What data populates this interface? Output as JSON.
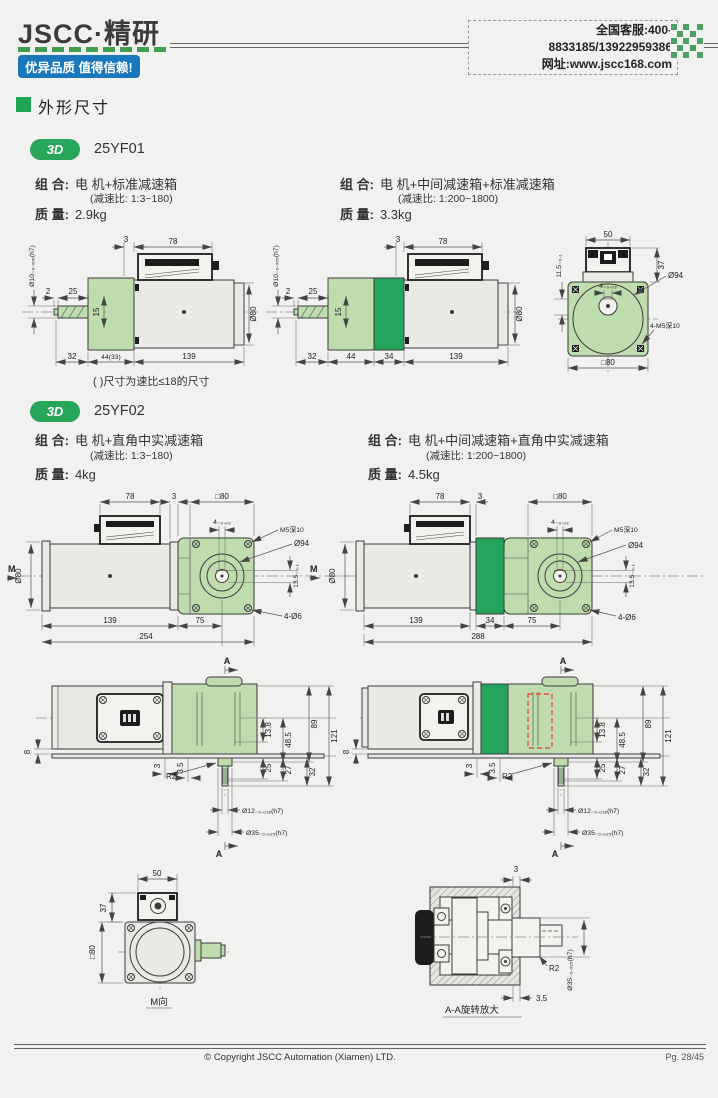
{
  "header": {
    "logo": "JSCC·精研",
    "slogan": "优异品质 值得信赖!",
    "service_line": "全国客服:400-8833185/13922959386",
    "website_line": "网址:www.jscc168.com"
  },
  "section": {
    "title": "外形尺寸"
  },
  "labels": {
    "combo": "组 合:",
    "mass": "质 量:"
  },
  "models": [
    {
      "badge": "3D",
      "name": "25YF01",
      "left": {
        "combo": "电 机+标准减速箱",
        "ratio": "(减速比: 1:3~180)",
        "mass": "2.9kg"
      },
      "right": {
        "combo": "电 机+中间减速箱+标准减速箱",
        "ratio": "(减速比: 1:200~1800)",
        "mass": "3.3kg"
      },
      "note": "( )尺寸为速比≤18的尺寸"
    },
    {
      "badge": "3D",
      "name": "25YF02",
      "left": {
        "combo": "电 机+直角中实减速箱",
        "ratio": "(减速比: 1:3~180)",
        "mass": "4kg"
      },
      "right": {
        "combo": "电 机+中间减速箱+直角中实减速箱",
        "ratio": "(减速比: 1:200~1800)",
        "mass": "4.5kg"
      }
    }
  ],
  "dims": {
    "yf01_left": {
      "t3": "3",
      "t78": "78",
      "shaft_dia": "Ø10₋₀.₀₀₅(h7)",
      "d2": "2",
      "d25": "25",
      "d15": "15",
      "dia80": "Ø80",
      "b32": "32",
      "b44": "44(33)",
      "b139": "139"
    },
    "yf01_mid": {
      "t3": "3",
      "t78": "78",
      "shaft_dia": "Ø10₋₀.₀₀₅(h7)",
      "d2": "2",
      "d25": "25",
      "d15": "15",
      "dia80": "Ø80",
      "b32": "32",
      "b44": "44",
      "b34": "34",
      "b139": "139"
    },
    "yf01_front": {
      "t50": "50",
      "r37": "37",
      "key": "4₋₀.₀₃",
      "dia94": "Ø94",
      "tap": "4-M5深10",
      "sq80": "□80",
      "kh": "11.5₋₀.₁"
    },
    "yf02_left": {
      "m": "M",
      "t78": "78",
      "t3": "3",
      "sq80": "□80",
      "key": "4₋₀.₀₃",
      "tap": "M5深10",
      "dia94": "Ø94",
      "dia80": "Ø80",
      "kh": "13.5₋₀.₁",
      "holes": "4-Ø6",
      "b139": "139",
      "b75": "75",
      "b254": "254"
    },
    "yf02_right": {
      "m": "M",
      "t78": "78",
      "t3": "3",
      "sq80": "□80",
      "key": "4₋₀.₀₃",
      "tap": "M5深10",
      "dia94": "Ø94",
      "dia80": "Ø80",
      "kh": "13.5₋₀.₁",
      "holes": "4-Ø6",
      "b139": "139",
      "b34": "34",
      "b75": "75",
      "b288": "288"
    },
    "side_left": {
      "a": "A",
      "d8": "8",
      "d3": "3",
      "d35": "3.5",
      "r2": "R2",
      "v138": "13.8",
      "v485": "48.5",
      "v89": "89",
      "v121": "121",
      "v25": "25",
      "v27": "27",
      "v32": "32",
      "shaft": "Ø12₋₀.₀₁₈(h7)",
      "boss": "Ø35₋₀.₀₂₅(h7)"
    },
    "side_right": {
      "a": "A",
      "d8": "8",
      "d3": "3",
      "d35": "3.5",
      "r2": "R2",
      "v138": "13.8",
      "v485": "48.5",
      "v89": "89",
      "v121": "121",
      "v25": "25",
      "v27": "27",
      "v32": "32",
      "shaft": "Ø12₋₀.₀₁₈(h7)",
      "boss": "Ø35₋₀.₀₂₅(h7)"
    },
    "m_view": {
      "t50": "50",
      "r37": "37",
      "sq80": "□80",
      "caption": "M向"
    },
    "aa_view": {
      "t3": "3",
      "r2": "R2",
      "d35": "3.5",
      "boss": "Ø35₋₀.₀₂₅(h7)",
      "caption": "A-A旋转放大"
    }
  },
  "colors": {
    "accent_green": "#1ea654",
    "gearbox_green": "#bedcae",
    "mid_gearbox_green": "#24a45c",
    "badge_blue": "#1977bb",
    "highlight_red": "#e23a2a"
  },
  "footer": {
    "copyright": "© Copyright JSCC Automation (Xiamen) LTD.",
    "page": "Pg. 28/45"
  }
}
